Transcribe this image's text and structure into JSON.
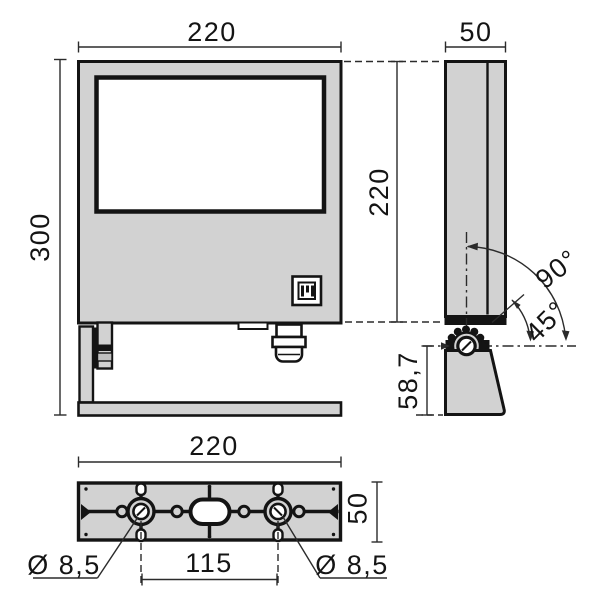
{
  "labels": {
    "front_width": "220",
    "side_depth": "50",
    "front_height": "300",
    "housing_height": "220",
    "angle_full": "90°",
    "angle_half": "45°",
    "pivot_height": "58,7",
    "bracket_length": "220",
    "bracket_depth": "50",
    "hole_left": "Ø 8,5",
    "hole_spacing": "115",
    "hole_right": "Ø 8,5"
  },
  "colors": {
    "background": "#ffffff",
    "surface": "#d2d2d2",
    "outline": "#141414",
    "dimension": "#2b2b2b"
  }
}
